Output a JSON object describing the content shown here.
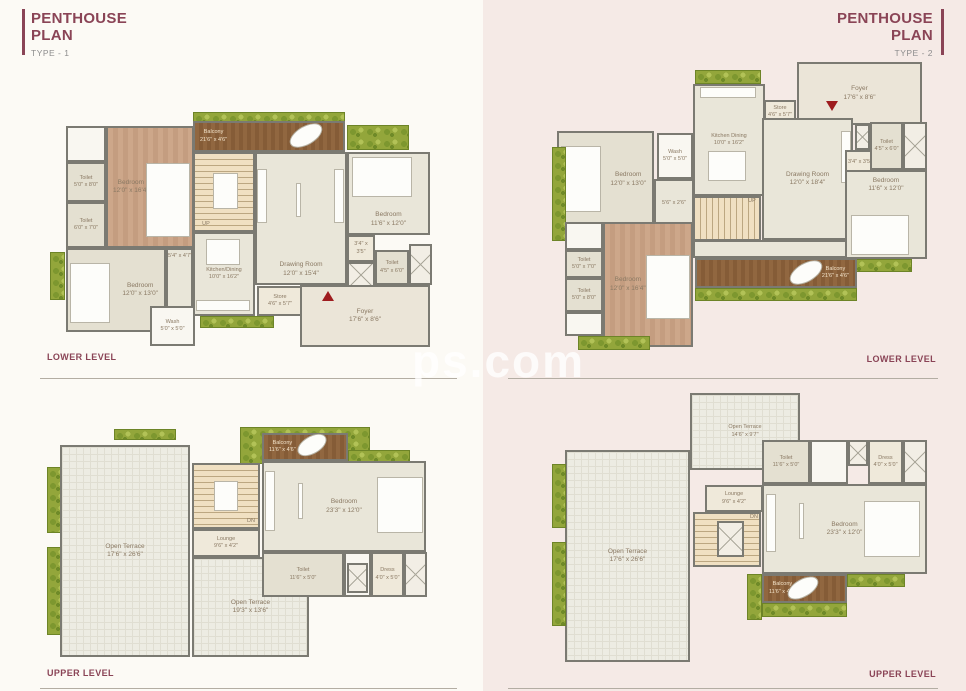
{
  "colors": {
    "accent": "#8a4456",
    "wall": "#7b7a72",
    "left_bg": "#fcfaf5",
    "right_bg": "#f5eae6"
  },
  "watermark": "ps.com",
  "left": {
    "title": "PENTHOUSE\nPLAN",
    "subtitle": "TYPE - 1",
    "lower": "LOWER LEVEL",
    "upper": "UPPER LEVEL"
  },
  "right": {
    "title": "PENTHOUSE\nPLAN",
    "subtitle": "TYPE - 2",
    "lower": "LOWER LEVEL",
    "upper": "UPPER LEVEL"
  },
  "rooms": {
    "t1l": {
      "balcony": "Balcony\n21'6\" x 4'6\"",
      "bedroom_master": "Bedroom\n12'0\" x 16'4\"",
      "toilet_a": "Toilet\n5'0\" x 8'0\"",
      "toilet_b": "Toilet\n6'0\" x 7'0\"",
      "bedroom_bl": "Bedroom\n12'0\" x 13'0\"",
      "wash": "Wash\n5'0\" x 5'0\"",
      "kitchen": "Kitchen/Dining\n10'0\" x 16'2\"",
      "store": "Store\n4'6\" x 5'7\"",
      "passage": "5'4\" x 4'7\"",
      "drawing": "Drawing Room\n12'0\" x 15'4\"",
      "up": "UP",
      "bedroom_r": "Bedroom\n11'6\" x 12'0\"",
      "lobby": "3'4\" x 3'5\"",
      "toilet_r": "Toilet\n4'5\" x 6'0\"",
      "foyer": "Foyer\n17'6\" x 8'6\""
    },
    "t1u": {
      "terrace_main": "Open Terrace\n17'6\" x 26'6\"",
      "terrace_ext": "Open Terrace\n19'3\" x 13'6\"",
      "lounge": "Lounge\n9'6\" x 4'2\"",
      "dn": "DN",
      "balcony": "Balcony\n11'6\" x 4'6\"",
      "bedroom": "Bedroom\n23'3\" x 12'0\"",
      "toilet": "Toilet\n11'6\" x 5'0\"",
      "dress": "Dress\n4'0\" x 5'0\""
    },
    "t2l": {
      "foyer": "Foyer\n17'6\" x 8'6\"",
      "kitchen": "Kitchen Dining\n10'0\" x 16'2\"",
      "store": "Store\n4'6\" x 5'7\"",
      "wash": "Wash\n5'0\" x 5'0\"",
      "drawing": "Drawing Room\n12'0\" x 18'4\"",
      "bedroom_l": "Bedroom\n12'0\" x 13'0\"",
      "passage": "5'6\" x 2'6\"",
      "up": "UP",
      "lobby": "3'4\" x 3'5\"",
      "toilet_r": "Toilet\n4'5\" x 6'0\"",
      "bedroom_r": "Bedroom\n11'6\" x 12'0\"",
      "bedroom_master": "Bedroom\n12'0\" x 16'4\"",
      "toilet_a": "Toilet\n5'0\" x 7'0\"",
      "toilet_b": "Toilet\n5'0\" x 8'0\"",
      "balcony": "Balcony\n21'6\" x 4'6\""
    },
    "t2u": {
      "terrace_top": "Open Terrace\n14'6\" x 9'7\"",
      "terrace_main": "Open Terrace\n17'6\" x 26'6\"",
      "lounge": "Lounge\n9'6\" x 4'2\"",
      "dn": "DN",
      "toilet": "Toilet\n11'6\" x 5'0\"",
      "dress": "Dress\n4'0\" x 5'0\"",
      "bedroom": "Bedroom\n23'3\" x 12'0\"",
      "balcony": "Balcony\n11'6\" x 4'6\""
    }
  }
}
